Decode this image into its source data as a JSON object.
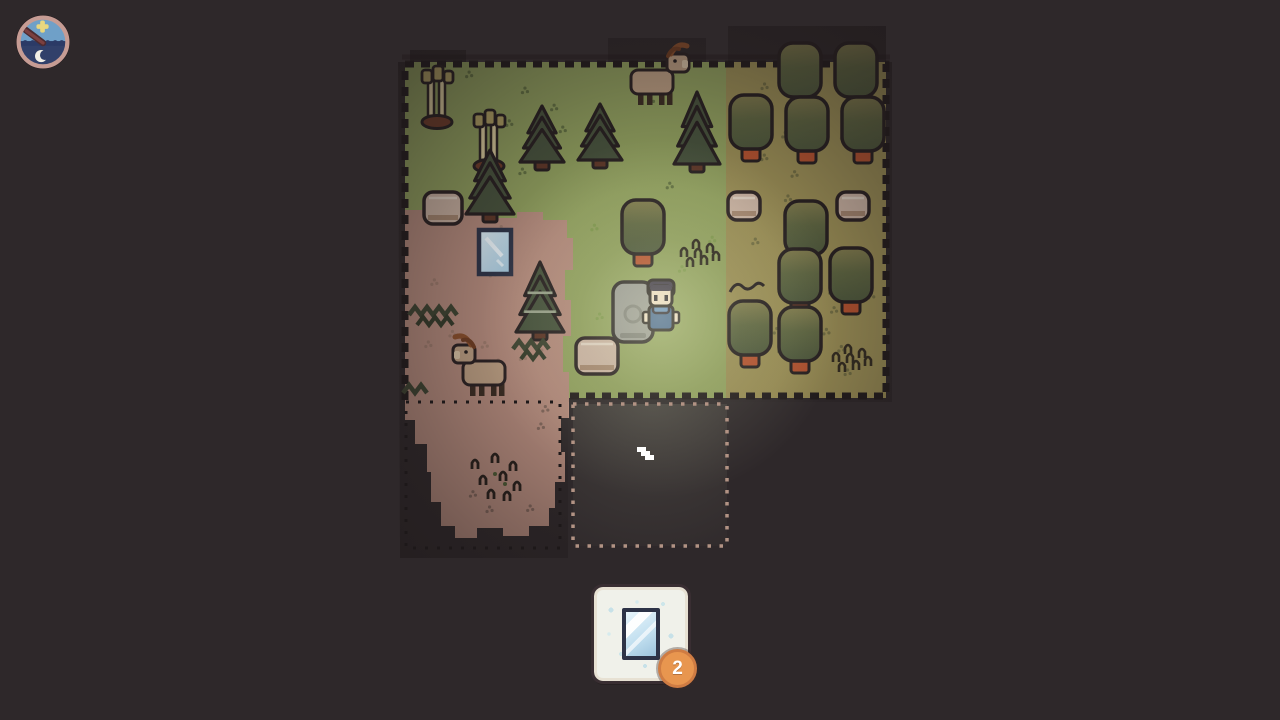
{
  "hud": {
    "clock": {
      "name": "day-night-clock",
      "hand_angle_deg": 217
    },
    "inventory": {
      "item": "glass-pane",
      "count": "2"
    }
  },
  "cursor": {
    "transform": "translate(637,447)"
  },
  "palette": {
    "background": "#2e282a",
    "grass_green": "#90a05e",
    "grass_yellow": "#9a8e55",
    "dirt": "#b38a7c",
    "outline": "#261f20",
    "canopy_top": "#827d4e",
    "canopy_bottom": "#4d583c",
    "pine": "#46523c",
    "trunk_orange": "#b5522f",
    "trunk_tan": "#9c8164",
    "stump": "#c9b2a2",
    "stone": "#989894",
    "goat": "#bb9e82",
    "horn": "#8a4f2b",
    "player_shirt": "#40608e",
    "player_scarf": "#6189ba",
    "skin": "#eedcc6",
    "hair": "#3a3346",
    "glass": "#bcdcee",
    "glass_frame": "#2d3347",
    "slot_bg": "#f0f1ea",
    "badge": "#e8964f",
    "plot_border": "#b29384",
    "glow": "#f2f7cf"
  },
  "map": {
    "entities": [
      {
        "type": "birch",
        "x": 437,
        "y": 68
      },
      {
        "type": "round-tree",
        "x": 800,
        "y": 70,
        "trunk": "tan"
      },
      {
        "type": "round-tree",
        "x": 856,
        "y": 70,
        "trunk": "tan"
      },
      {
        "type": "goat",
        "x": 655,
        "y": 82,
        "dir": 1
      },
      {
        "type": "pine",
        "x": 697,
        "y": 92,
        "w": 46,
        "h": 72
      },
      {
        "type": "pine",
        "x": 542,
        "y": 106,
        "w": 44,
        "h": 56
      },
      {
        "type": "pine",
        "x": 600,
        "y": 104,
        "w": 44,
        "h": 56
      },
      {
        "type": "birch",
        "x": 489,
        "y": 112
      },
      {
        "type": "round-tree",
        "x": 751,
        "y": 122,
        "trunk": "orange"
      },
      {
        "type": "round-tree",
        "x": 807,
        "y": 124,
        "trunk": "orange"
      },
      {
        "type": "round-tree",
        "x": 863,
        "y": 124,
        "trunk": "orange"
      },
      {
        "type": "pine",
        "x": 490,
        "y": 150,
        "w": 48,
        "h": 64
      },
      {
        "type": "stump",
        "x": 443,
        "y": 208,
        "w": 38,
        "h": 32
      },
      {
        "type": "stump",
        "x": 744,
        "y": 206,
        "w": 32,
        "h": 28
      },
      {
        "type": "stump",
        "x": 853,
        "y": 206,
        "w": 32,
        "h": 28
      },
      {
        "type": "round-tree",
        "x": 806,
        "y": 228,
        "trunk": "none"
      },
      {
        "type": "round-tree",
        "x": 643,
        "y": 227,
        "trunk": "orange"
      },
      {
        "type": "glass-pane",
        "x": 495,
        "y": 252
      },
      {
        "type": "tall-grass",
        "x": 700,
        "y": 252
      },
      {
        "type": "pine",
        "x": 540,
        "y": 262,
        "w": 48,
        "h": 70,
        "variant": "light"
      },
      {
        "type": "round-tree",
        "x": 800,
        "y": 276,
        "trunk": "orange"
      },
      {
        "type": "round-tree",
        "x": 851,
        "y": 275,
        "trunk": "orange"
      },
      {
        "type": "stone",
        "x": 633,
        "y": 312
      },
      {
        "type": "player",
        "x": 661,
        "y": 312
      },
      {
        "type": "zigzag",
        "x": 438,
        "y": 312,
        "w": 58
      },
      {
        "type": "round-tree",
        "x": 750,
        "y": 328,
        "trunk": "orange",
        "deco": "squiggle"
      },
      {
        "type": "round-tree",
        "x": 800,
        "y": 334,
        "trunk": "orange"
      },
      {
        "type": "zigzag",
        "x": 536,
        "y": 346,
        "w": 46
      },
      {
        "type": "stump",
        "x": 597,
        "y": 356,
        "w": 42,
        "h": 36
      },
      {
        "type": "tall-grass",
        "x": 852,
        "y": 357
      },
      {
        "type": "goat",
        "x": 487,
        "y": 373,
        "dir": -1
      },
      {
        "type": "zigzag",
        "x": 416,
        "y": 390,
        "w": 26
      },
      {
        "type": "dirt-sprouts",
        "x": 497,
        "y": 480
      }
    ]
  }
}
